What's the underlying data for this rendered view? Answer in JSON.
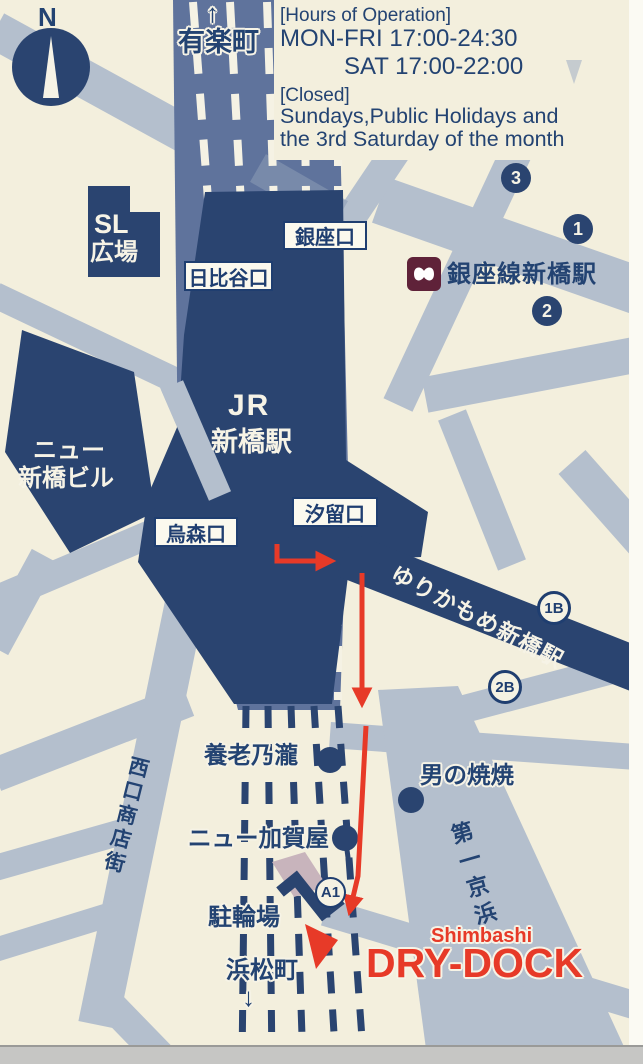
{
  "info": {
    "hours_header": "[Hours of Operation]",
    "hours_weekday": "MON-FRI 17:00-24:30",
    "hours_saturday": "SAT 17:00-22:00",
    "closed_header": "[Closed]",
    "closed_line1": "Sundays,Public Holidays and",
    "closed_line2": "the 3rd Saturday of the month"
  },
  "compass": {
    "label": "N"
  },
  "stations": {
    "yurakucho": "有楽町",
    "yurakucho_dir": "↑",
    "jr_prefix": "JR",
    "jr_name": "新橋駅",
    "ginza_line": "銀座線新橋駅",
    "yurikamome": "ゆりかもめ新橋駅",
    "hamamatsucho": "浜松町",
    "hamamatsucho_dir": "↓"
  },
  "exits": {
    "ginza": "銀座口",
    "hibiya": "日比谷口",
    "karasumori": "烏森口",
    "shiodome": "汐留口"
  },
  "badges": {
    "n3": "3",
    "n1": "1",
    "n2": "2",
    "b1": "1B",
    "b2": "2B",
    "a1": "A1"
  },
  "places": {
    "sl_plaza_1": "SL",
    "sl_plaza_2": "広場",
    "new_shimbashi_1": "ニュー",
    "new_shimbashi_2": "新橋ビル",
    "yoronotaki": "養老乃瀧",
    "otoko_yakiyaki": "男の焼焼",
    "new_kagaya": "ニュー加賀屋",
    "bicycle_parking": "駐輪場"
  },
  "streets": {
    "west_exit_shopping": "西口商店街",
    "daiichi_keihin": "第一京浜"
  },
  "venue": {
    "area": "Shimbashi",
    "name": "DRY-DOCK"
  },
  "colors": {
    "background": "#f3efdd",
    "navy": "#2a4470",
    "rail_band": "#5f739c",
    "street_gray": "#b4bfcd",
    "route_red": "#e73a28",
    "metro_maroon": "#5f2239"
  }
}
